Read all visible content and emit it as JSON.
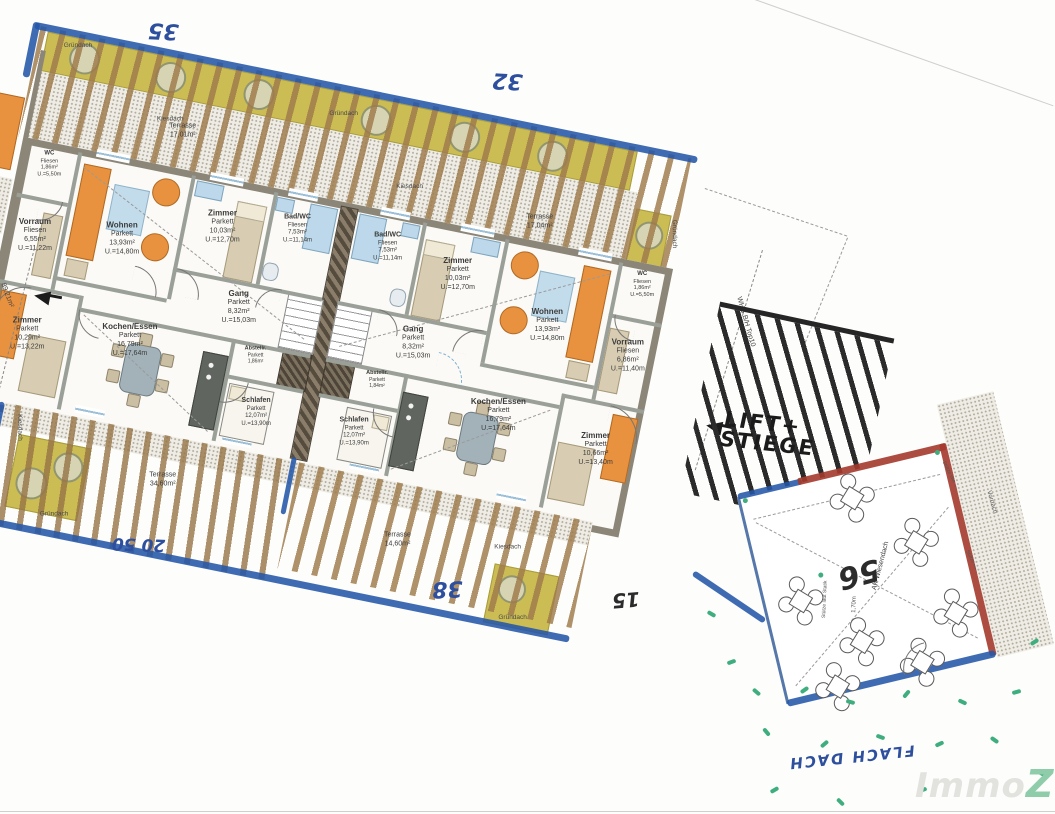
{
  "watermark": {
    "gray": "Immo",
    "green": "Z"
  },
  "roof": {
    "gruendach": "Gründach",
    "kiesdach": "Kiesdach"
  },
  "handwriting": {
    "n35": "35",
    "n32": "32",
    "n38": "38",
    "n15": "15",
    "n20_50": "20 50",
    "n56": "56",
    "lift_line1": "LIFT+",
    "lift_line2": "STIEGE",
    "flachdach": "FLACH DACH"
  },
  "side_labels": {
    "whg_top10": "WHG B/H Top10",
    "area_total": "89,21m²",
    "vordach": "Vordach",
    "ak_wiesendach": "AK Wiesendach",
    "stuetze": "Stütze laut Statik",
    "height_note": "1,70m"
  },
  "units": {
    "left": {
      "wc": {
        "name": "WC",
        "floor": "Fliesen",
        "area": "1,86m²",
        "per": "U.=5,50m"
      },
      "vorraum": {
        "name": "Vorraum",
        "floor": "Fliesen",
        "area": "6,55m²",
        "per": "U.=11,22m"
      },
      "wohnen": {
        "name": "Wohnen",
        "floor": "Parkett",
        "area": "13,93m²",
        "per": "U.=14,80m"
      },
      "zimmer_top": {
        "name": "Zimmer",
        "floor": "Parkett",
        "area": "10,03m²",
        "per": "U.=12,70m"
      },
      "bad": {
        "name": "Bad/WC",
        "floor": "Fliesen",
        "area": "7,53m²",
        "per": "U.=11,14m"
      },
      "gang": {
        "name": "Gang",
        "floor": "Parkett",
        "area": "8,32m²",
        "per": "U.=15,03m"
      },
      "kochen": {
        "name": "Kochen/Essen",
        "floor": "Parkett",
        "area": "16,79m²",
        "per": "U.=17,64m"
      },
      "abstell": {
        "name": "Abstellr.",
        "floor": "Parkett",
        "area": "1,86m²",
        "per": "U.=5,60m"
      },
      "schlafen": {
        "name": "Schlafen",
        "floor": "Parkett",
        "area": "12,07m²",
        "per": "U.=13,90m"
      },
      "zimmer_bottom": {
        "name": "Zimmer",
        "floor": "Parkett",
        "area": "10,29m²",
        "per": "U.=13,22m"
      },
      "terrasse_top": {
        "name": "Terrasse",
        "area": "17,01m²"
      },
      "terrasse_bottom": {
        "name": "Terrasse",
        "area": "34,60m²"
      }
    },
    "right": {
      "wc": {
        "name": "WC",
        "floor": "Fliesen",
        "area": "1,86m²",
        "per": "U.=5,50m"
      },
      "vorraum": {
        "name": "Vorraum",
        "floor": "Fliesen",
        "area": "6,86m²",
        "per": "U.=11,40m"
      },
      "wohnen": {
        "name": "Wohnen",
        "floor": "Parkett",
        "area": "13,93m²",
        "per": "U.=14,80m"
      },
      "zimmer_top": {
        "name": "Zimmer",
        "floor": "Parkett",
        "area": "10,03m²",
        "per": "U.=12,70m"
      },
      "bad": {
        "name": "Bad/WC",
        "floor": "Fliesen",
        "area": "7,53m²",
        "per": "U.=11,14m"
      },
      "gang": {
        "name": "Gang",
        "floor": "Parkett",
        "area": "8,32m²",
        "per": "U.=15,03m"
      },
      "kochen": {
        "name": "Kochen/Essen",
        "floor": "Parkett",
        "area": "16,79m²",
        "per": "U.=17,64m"
      },
      "abstell": {
        "name": "Abstellr.",
        "floor": "Parkett",
        "area": "1,84m²",
        "per": "U.=5,60m"
      },
      "schlafen": {
        "name": "Schlafen",
        "floor": "Parkett",
        "area": "12,07m²",
        "per": "U.=13,90m"
      },
      "zimmer_bottom": {
        "name": "Zimmer",
        "floor": "Parkett",
        "area": "10,66m²",
        "per": "U.=13,40m"
      },
      "terrasse_top": {
        "name": "Terrasse",
        "area": "17,04m²"
      },
      "terrasse_bottom": {
        "name": "Terrasse",
        "area": "14,60m²"
      }
    }
  },
  "colors": {
    "marker_blue": "#2456a8",
    "marker_red": "#a43a2c",
    "marker_black": "#262626",
    "pen_blue": "#2d4f9e",
    "grass_green": "#3fae7e",
    "wood": "#9e7a4a",
    "green_roof": "#cbbd54",
    "watermark_green": "#8fcdaa"
  }
}
